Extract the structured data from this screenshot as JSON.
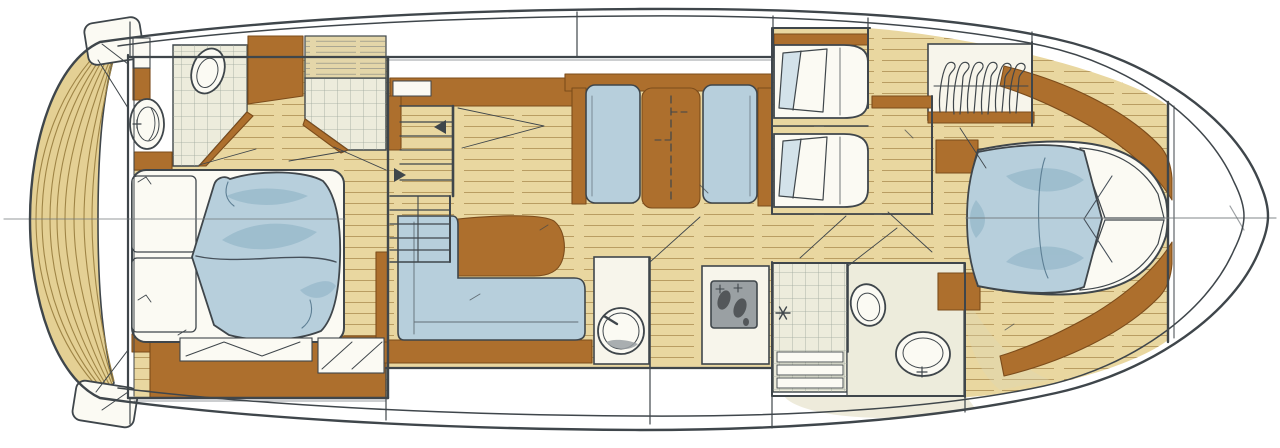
{
  "meta": {
    "title": "Motor yacht lower-deck interior floor plan (hand-drawn watercolor rendering)",
    "orientation": "bow-right-stern-left",
    "style": "marker-and-watercolor sketch, no text labels"
  },
  "palette": {
    "paper": "#ffffff",
    "ink": "#3f464b",
    "ink_soft": "#70767a",
    "wood": "#e9d7a0",
    "wood_line": "#ad8f52",
    "teak": "#e4d094",
    "teak_line": "#9c8142",
    "louver": "#e4d6a9",
    "brown": "#ad6f2d",
    "brown_edge": "#7c4c1b",
    "blue": "#b7cfdc",
    "blue_deep": "#8fb3c6",
    "blue_soft": "#d3e2ea",
    "linen": "#fbfaf3",
    "tile": "#edecdc",
    "tile_line": "#95a095",
    "olive_wash": "#ddd8b8",
    "counter": "#f7f5eb",
    "stove": "#9aa0a3",
    "stove_dark": "#53575a",
    "rub_rail": "#8f9493"
  },
  "rooms": [
    {
      "name": "swim-platform",
      "position": "stern (far left)",
      "finish": "curved teak planks"
    },
    {
      "name": "aft-owners-cabin",
      "position": "left",
      "contents": [
        "double-berth",
        "two-pillows",
        "duvet",
        "bedside-shelves",
        "stowage-cabinets"
      ]
    },
    {
      "name": "aft-head",
      "position": "top-left",
      "contents": [
        "toilet",
        "washbasin",
        "wardrobe",
        "shower-stall"
      ]
    },
    {
      "name": "companionway-stairs",
      "position": "center-left",
      "contents": [
        "two-flights",
        "direction-arrows"
      ]
    },
    {
      "name": "dinette",
      "position": "top-center",
      "contents": [
        "port-settee",
        "folding-table",
        "starboard-settee"
      ]
    },
    {
      "name": "saloon-lounge",
      "position": "bottom-center",
      "contents": [
        "l-shaped-sofa",
        "coffee-table",
        "sideboard"
      ]
    },
    {
      "name": "galley",
      "position": "bottom-center-right",
      "contents": [
        "round-sink",
        "counter",
        "stove-two-burners"
      ]
    },
    {
      "name": "day-head",
      "position": "bottom-right-of-center",
      "contents": [
        "tiled-shower",
        "drain",
        "toilet",
        "round-basin"
      ]
    },
    {
      "name": "guest-cabin-forward-upper",
      "position": "top-right-of-center",
      "contents": [
        "single-berth",
        "pillow",
        "shelf"
      ]
    },
    {
      "name": "guest-cabin-forward-lower",
      "position": "right-of-center",
      "contents": [
        "single-berth",
        "pillow"
      ]
    },
    {
      "name": "hanging-locker",
      "position": "top-right",
      "contents": [
        "clothes-hangers",
        "rail"
      ]
    },
    {
      "name": "forward-owners-cabin",
      "position": "bow (right)",
      "contents": [
        "island-double-berth",
        "duvet",
        "two-pillows",
        "hull-side-shelves",
        "two-dressers"
      ]
    },
    {
      "name": "bow-locker",
      "position": "far right",
      "contents": []
    }
  ],
  "drawing_marks": {
    "centerline": "horizontal construction line across stern and bow",
    "door_swings": "thin diagonal strokes at each doorway",
    "stair_arrows": "two small solid triangles"
  }
}
